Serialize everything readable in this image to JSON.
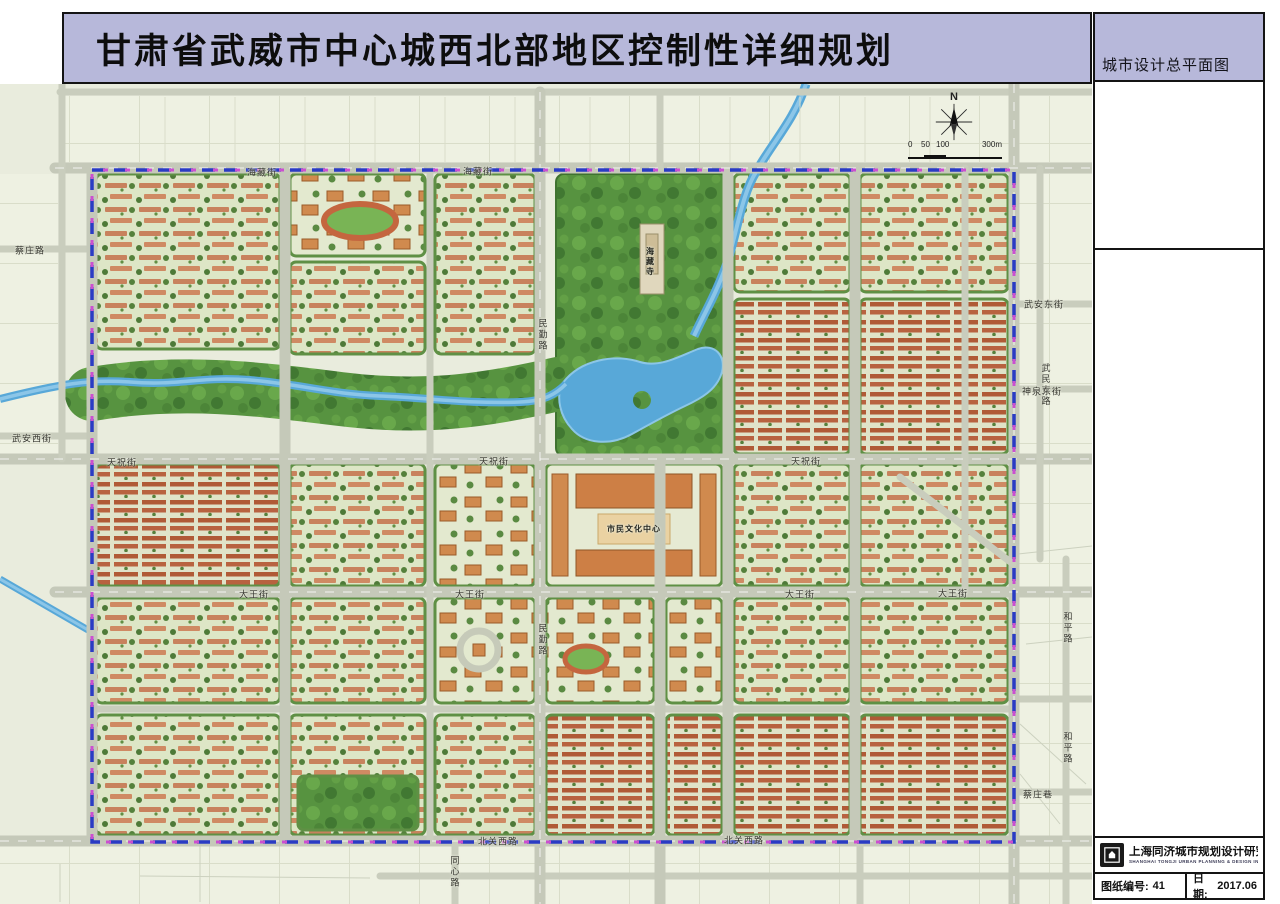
{
  "title": "甘肃省武威市中心城西北部地区控制性详细规划",
  "side_panel": {
    "heading": "城市设计总平面图",
    "institute_name": "上海同济城市规划设计研究院",
    "institute_name_en": "SHANGHAI TONGJI URBAN PLANNING & DESIGN INSTITUTE",
    "drawing_no_label": "图纸编号:",
    "drawing_no": "41",
    "date_label": "日期:",
    "date": "2017.06"
  },
  "map": {
    "north_label": "N",
    "scale_ticks": [
      "0",
      "50",
      "100"
    ],
    "scale_end": "300m",
    "colors": {
      "header_lavender": "#b7b8da",
      "map_background": "#e9ecdd",
      "road_gray": "#c5c9b9",
      "park_green": "#579340",
      "water_blue": "#58a8d8",
      "boundary_blue": "#2a3bc4",
      "boundary_magenta": "#cb4fd0",
      "roof_red": "#b05a36",
      "roof_salmon": "#c8825d"
    },
    "labels": [
      {
        "text": "海藏街",
        "x": 262,
        "y": 172
      },
      {
        "text": "海藏街",
        "x": 478,
        "y": 171
      },
      {
        "text": "天祝街",
        "x": 122,
        "y": 462
      },
      {
        "text": "天祝街",
        "x": 494,
        "y": 461
      },
      {
        "text": "天祝街",
        "x": 806,
        "y": 461
      },
      {
        "text": "大王街",
        "x": 254,
        "y": 594
      },
      {
        "text": "大王街",
        "x": 470,
        "y": 594
      },
      {
        "text": "大王街",
        "x": 800,
        "y": 594
      },
      {
        "text": "大王街",
        "x": 953,
        "y": 593
      },
      {
        "text": "北关西路",
        "x": 498,
        "y": 841
      },
      {
        "text": "北关西路",
        "x": 744,
        "y": 840
      },
      {
        "text": "民勤路",
        "x": 543,
        "y": 335,
        "v": true
      },
      {
        "text": "民勤路",
        "x": 543,
        "y": 640,
        "v": true
      },
      {
        "text": "同心路",
        "x": 455,
        "y": 872,
        "v": true
      },
      {
        "text": "蔡庄路",
        "x": 30,
        "y": 250
      },
      {
        "text": "武安西街",
        "x": 32,
        "y": 438
      },
      {
        "text": "武安东街",
        "x": 1044,
        "y": 304
      },
      {
        "text": "武民支路",
        "x": 1046,
        "y": 385,
        "v": true
      },
      {
        "text": "神泉东街",
        "x": 1042,
        "y": 391
      },
      {
        "text": "和平路",
        "x": 1068,
        "y": 628,
        "v": true
      },
      {
        "text": "和平路",
        "x": 1068,
        "y": 748,
        "v": true
      },
      {
        "text": "蔡庄巷",
        "x": 1038,
        "y": 794
      },
      {
        "text": "海藏寺",
        "x": 650,
        "y": 262,
        "v": true,
        "kind": "place"
      },
      {
        "text": "市民文化中心",
        "x": 634,
        "y": 529,
        "kind": "place"
      }
    ]
  }
}
